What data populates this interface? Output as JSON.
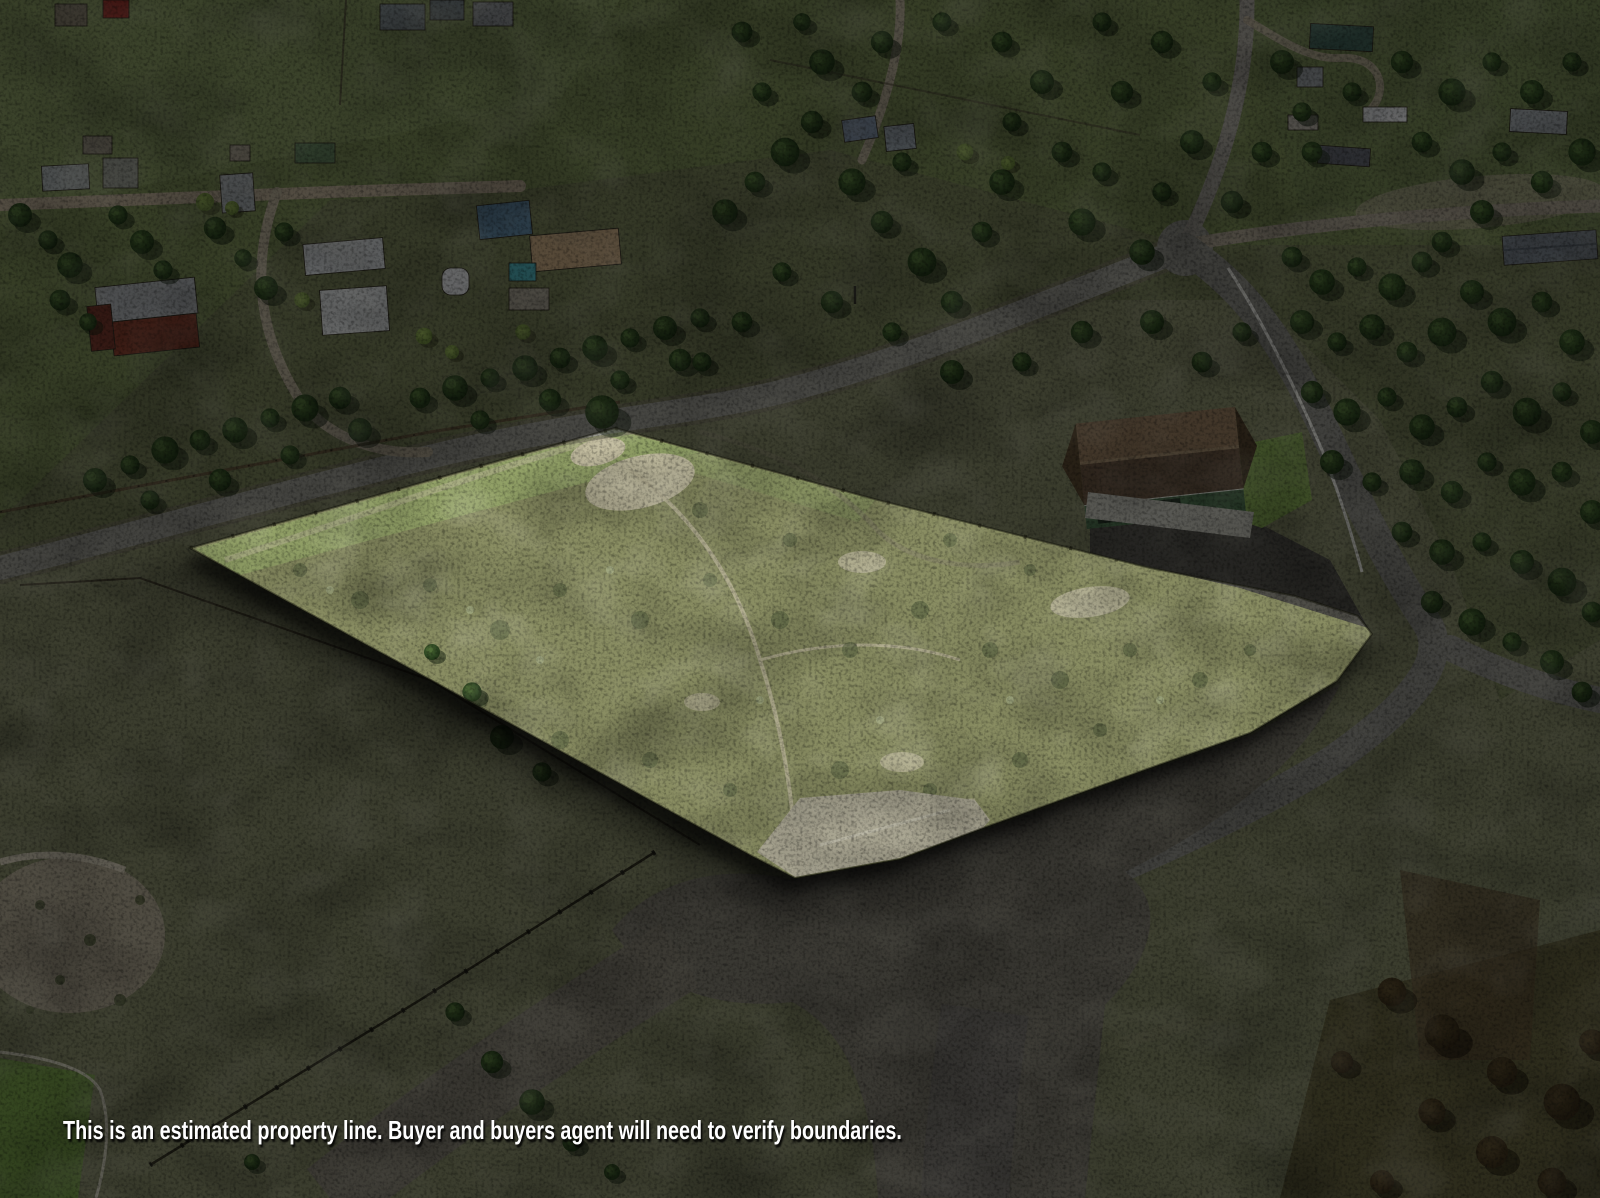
{
  "page": {
    "title": "Aerial property photo with estimated property line"
  },
  "photo": {
    "type": "aerial-drone-photograph",
    "subject": "rural lot highlighted by brightened polygon; surroundings dimmed",
    "highlighted_parcel": {
      "dim_overlay_opacity": 0.52,
      "effect": "raised parcel with drop shadow"
    },
    "palette": {
      "parcel_grass": "#898d62",
      "dim_field": "#3a4530",
      "paved_road": "#8e8e86",
      "cul_de_sac": "#787569",
      "gravel": "#ac9f89",
      "trees": "#2f4a28",
      "house_roof": "#6b5742",
      "house_walls": "#4a6b4b",
      "caption_color": "#ffffff"
    }
  },
  "caption": {
    "text": "This is an estimated property line. Buyer and buyers agent will need to verify boundaries."
  }
}
